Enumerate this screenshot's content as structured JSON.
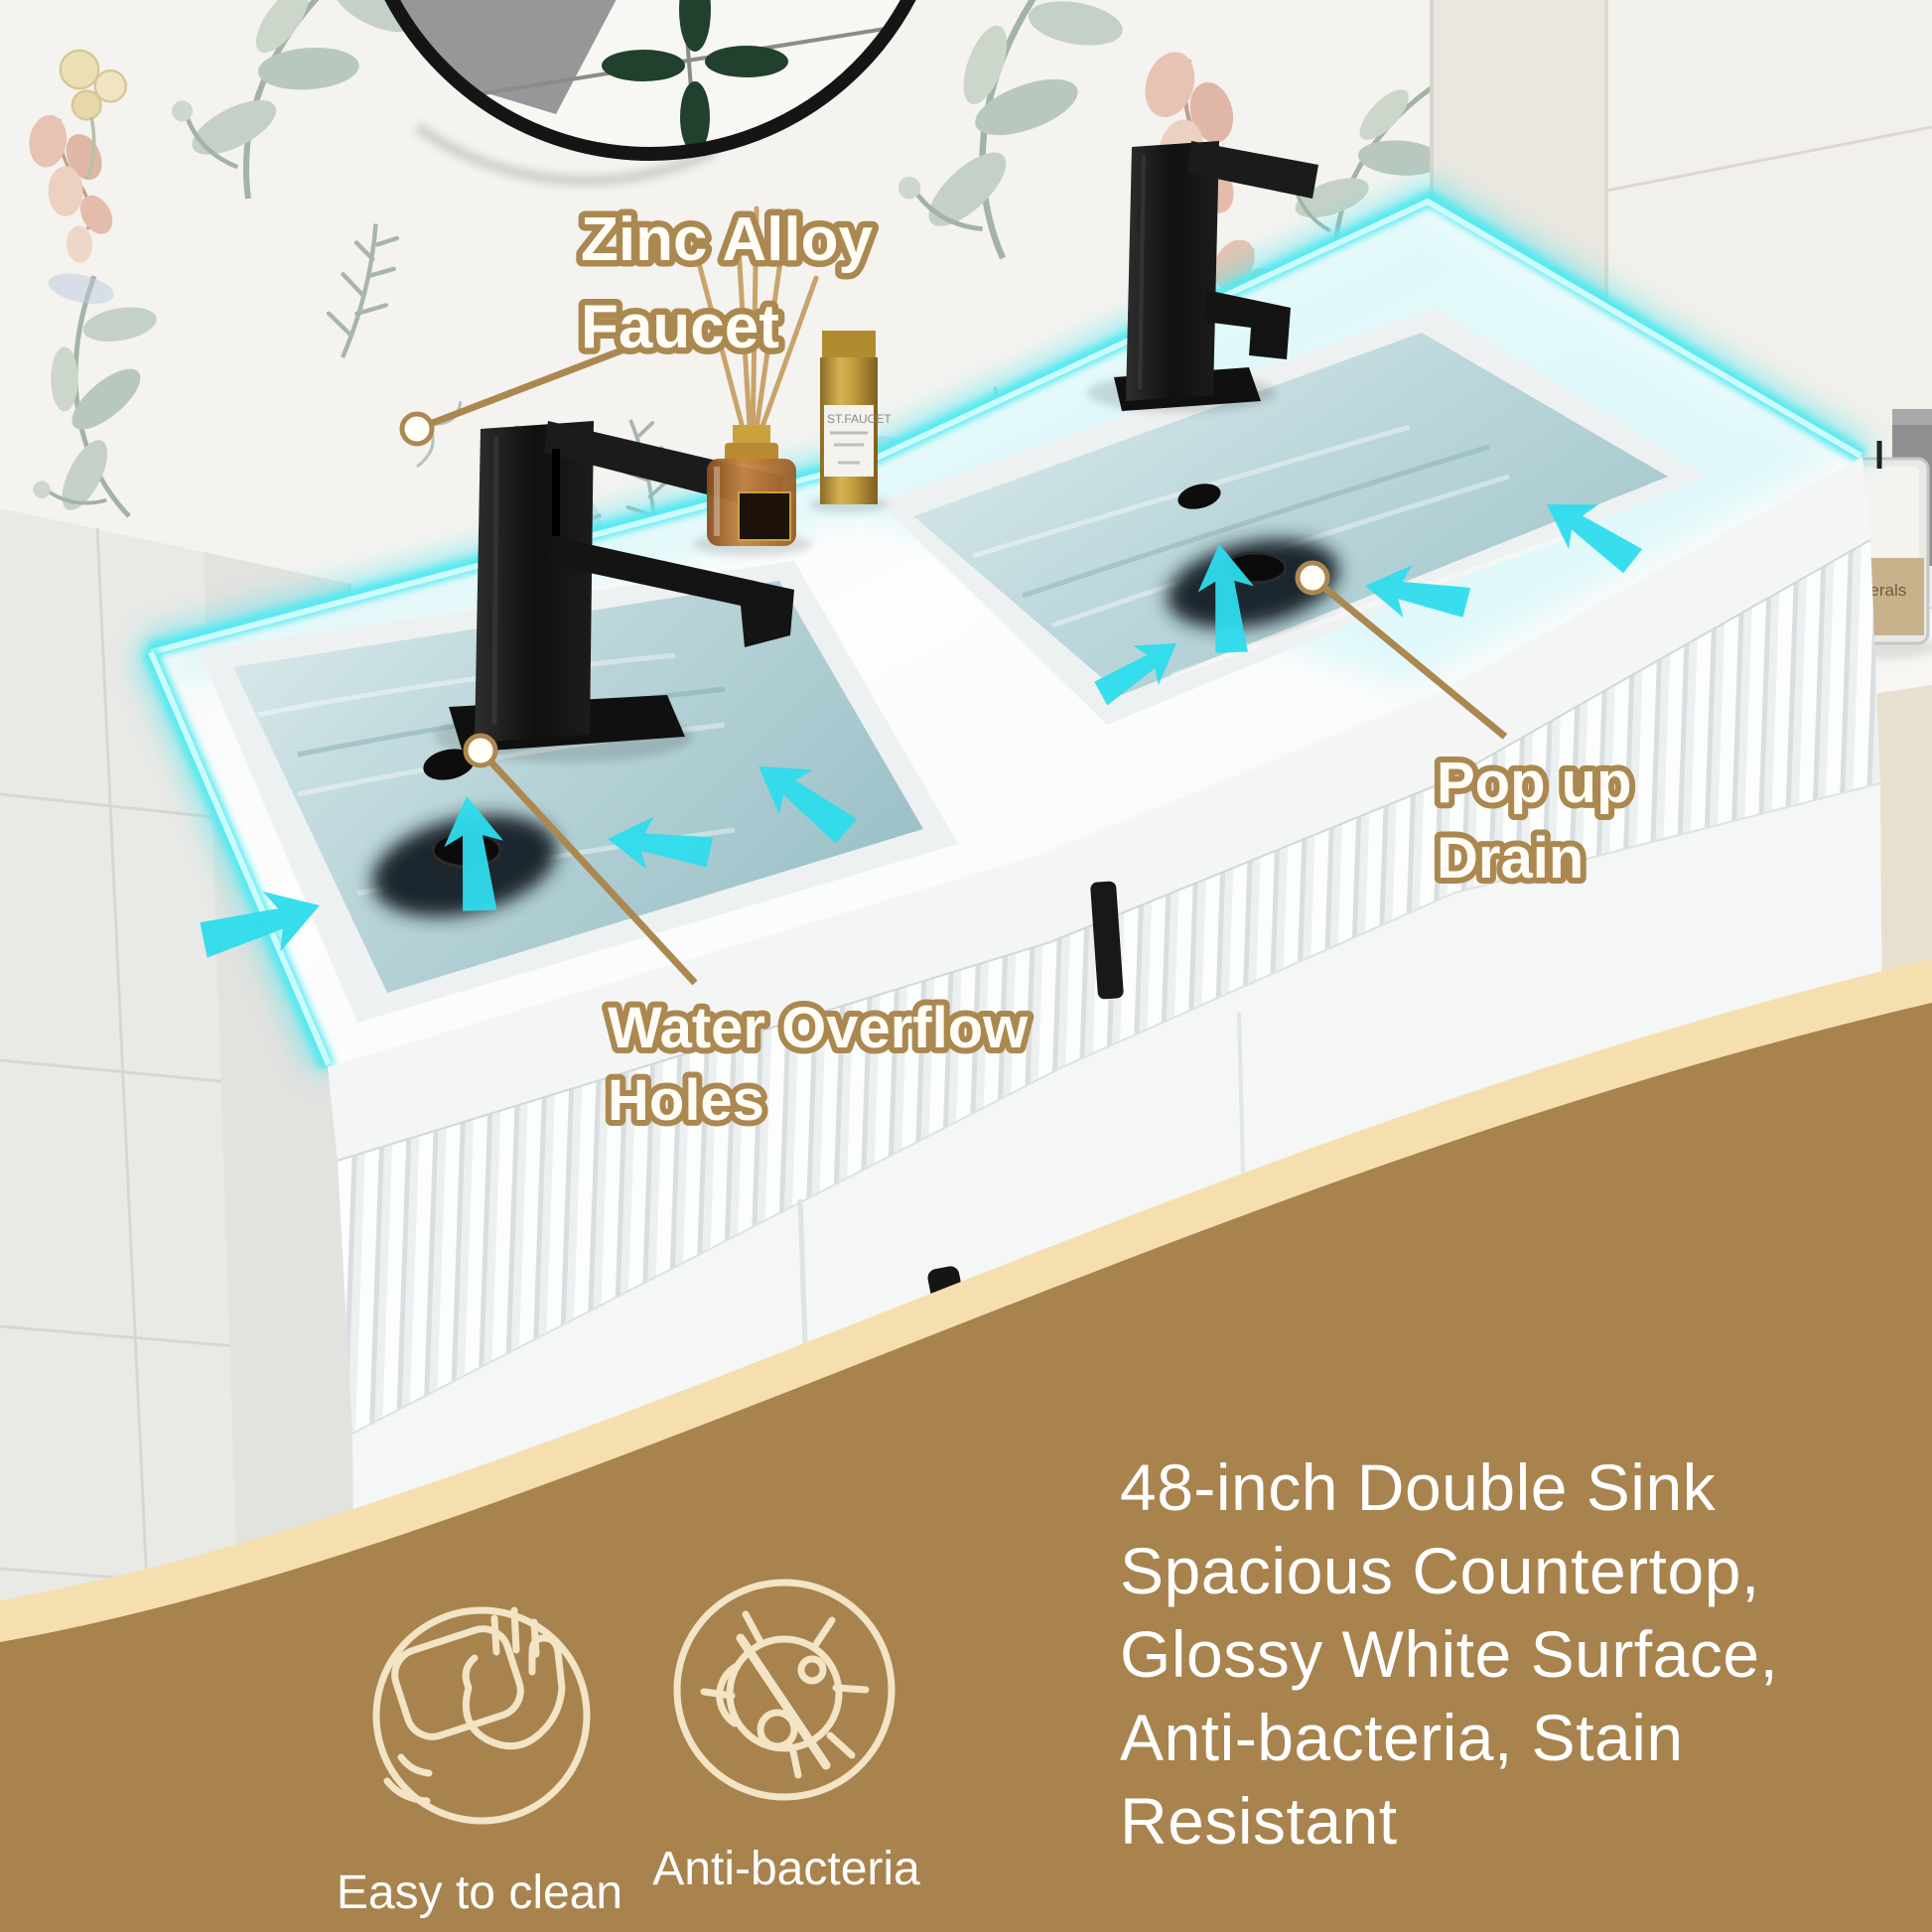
{
  "image_type": "product-marketing-photo",
  "product": "48-inch double sink bathroom vanity",
  "colors": {
    "callout_tan": "#ab8850",
    "panel_brown": "#a8834e",
    "panel_cream_band": "#f5dfae",
    "icon_cream": "#f2e4c4",
    "glow_cyan": "#3fe3ee",
    "arrow_cyan": "#2edcec",
    "water_blue": "#aeccd1",
    "text_white": "#ffffff",
    "faucet_black": "#141414"
  },
  "callouts": {
    "faucet": {
      "line1": "Zinc Alloy",
      "line2": "Faucet"
    },
    "drain": {
      "line1": "Pop up",
      "line2": "Drain"
    },
    "overflow": {
      "line1": "Water Overflow",
      "line2": "Holes"
    }
  },
  "info_panel": {
    "description": "48-inch Double Sink Spacious Countertop, Glossy White Surface, Anti-bacteria, Stain Resistant",
    "features": [
      {
        "icon": "hand-wipe-icon",
        "label": "Easy to clean"
      },
      {
        "icon": "no-bacteria-icon",
        "label": "Anti-bacteria"
      }
    ]
  },
  "props": {
    "perfume_label": "ST.FAUCET",
    "candle_label": "minerals"
  }
}
